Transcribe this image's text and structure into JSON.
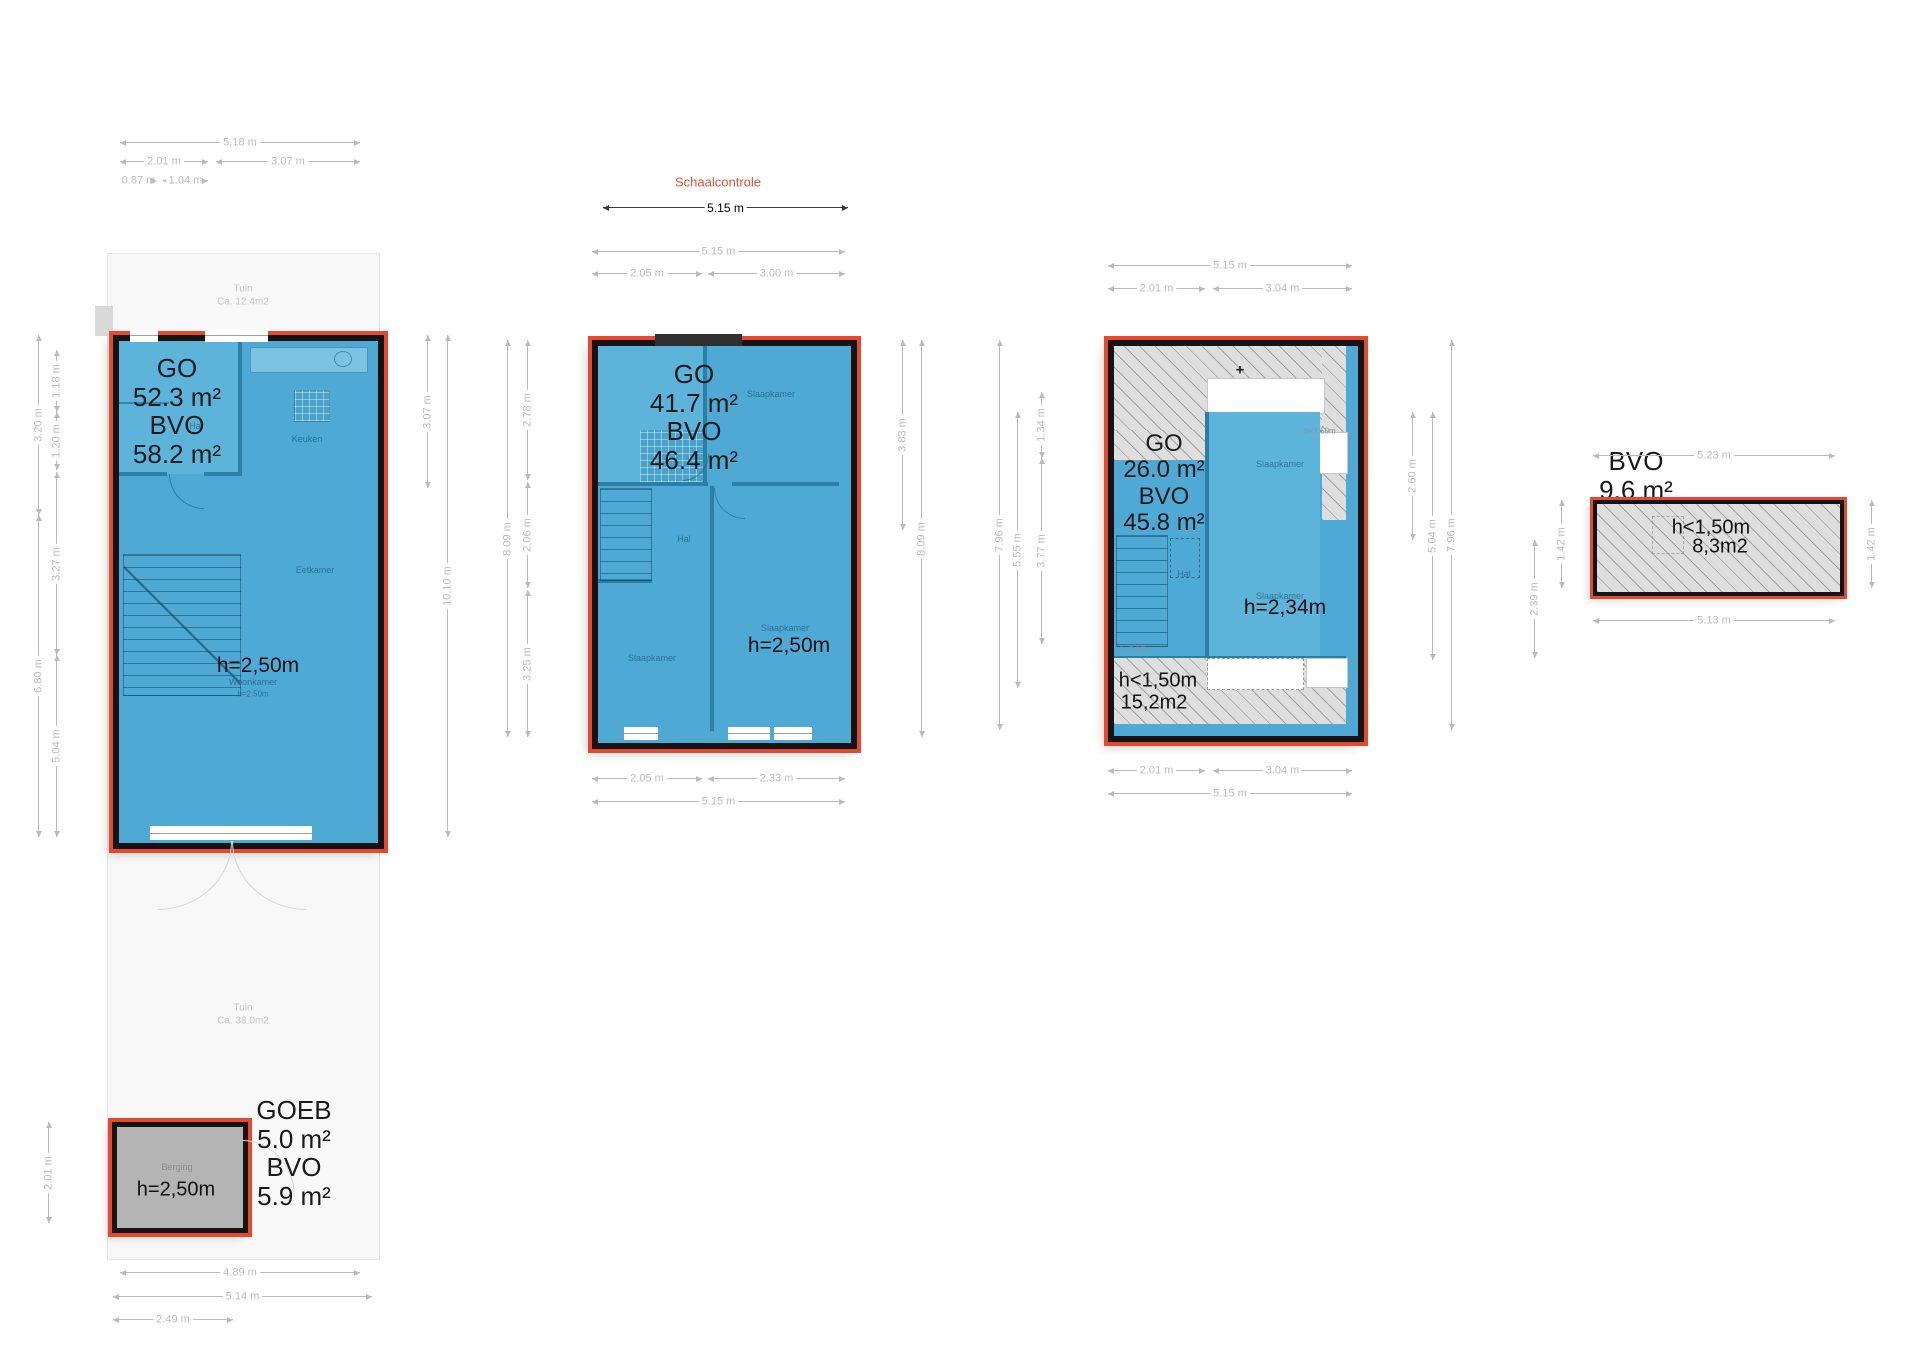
{
  "document": {
    "type": "floor-plan-measurement-drawing"
  },
  "colors": {
    "plan_fill": "#4FA9D5",
    "plan_border": "#141414",
    "highlight_outline": "#E8492B",
    "dimension_text": "#BBBBBB",
    "hatch_background": "#DEDEDE",
    "storage_fill": "#B4B4B4",
    "garden_background": "#F8F8F8",
    "accent_text": "#D9533B"
  },
  "scale_check": {
    "label": "Schaalcontrole",
    "value": "5.15 m"
  },
  "garden": {
    "front_name": "Tuin",
    "front_area": "Ca. 12.4m2",
    "back_name": "Tuin",
    "back_area": "Ca. 38.0m2"
  },
  "plans": [
    {
      "name": "ground-floor",
      "go_label": "GO",
      "go_value": "52.3 m²",
      "bvo_label": "BVO",
      "bvo_value": "58.2 m²",
      "height": "h=2,50m",
      "rooms": {
        "hal": "Hal",
        "keuken": "Keuken",
        "eetkamer": "Eetkamer",
        "woonkamer": "Woonkamer",
        "woonkamer_h": "h=2,50m"
      }
    },
    {
      "name": "first-floor",
      "go_label": "GO",
      "go_value": "41.7 m²",
      "bvo_label": "BVO",
      "bvo_value": "46.4 m²",
      "height": "h=2,50m",
      "rooms": {
        "hal": "Hal",
        "slaapkamer_top": "Slaapkamer",
        "slaapkamer_left": "Slaapkamer",
        "slaapkamer_right": "Slaapkamer"
      }
    },
    {
      "name": "second-floor",
      "go_label": "GO",
      "go_value": "26.0 m²",
      "bvo_label": "BVO",
      "bvo_value": "45.8 m²",
      "height": "h=2,34m",
      "low_area_label": "h<1,50m",
      "low_area_value": "15,2m2",
      "low_small_left": "h<1,50m",
      "low_small_right": "h<1,50m",
      "plus": "+",
      "rooms": {
        "hal": "Hal",
        "slaapkamer": "Slaapkamer",
        "slaapkamer2": "Slaapkamer"
      }
    },
    {
      "name": "attic-low",
      "bvo_label": "BVO",
      "bvo_value": "9.6 m²",
      "low_area_label": "h<1,50m",
      "low_area_value": "8,3m2"
    }
  ],
  "storage": {
    "goeb_label": "GOEB",
    "goeb_value": "5.0 m²",
    "bvo_label": "BVO",
    "bvo_value": "5.9 m²",
    "height": "h=2,50m",
    "room": "Berging"
  },
  "dimensions": {
    "plan1_top": [
      "5.18 m",
      "2.01 m",
      "3.07 m",
      "0.87 m",
      "1.04 m"
    ],
    "plan1_left": [
      "1.18 m",
      "1.20 m",
      "3.27 m",
      "5.04 m",
      "3.20 m",
      "6.80 m"
    ],
    "plan1_right": [
      "3.07 m",
      "10.10 m"
    ],
    "plan1_bottom": [
      "4.89 m",
      "5.14 m",
      "2.49 m"
    ],
    "storage_left": [
      "2.01 m"
    ],
    "plan2_top": [
      "5.15 m",
      "2.05 m",
      "3.00 m"
    ],
    "plan2_left": [
      "2.78 m",
      "2.06 m",
      "3.25 m",
      "8.09 m"
    ],
    "plan2_right": [
      "3.83 m",
      "8.09 m"
    ],
    "plan2_bottom": [
      "2.05 m",
      "2.33 m",
      "5.15 m"
    ],
    "plan3_top": [
      "5.15 m",
      "2.01 m",
      "3.04 m"
    ],
    "plan3_left": [
      "1.34 m",
      "3.77 m",
      "5.55 m",
      "7.96 m"
    ],
    "plan3_right": [
      "2.60 m",
      "5.04 m",
      "7.96 m",
      "2.39 m"
    ],
    "plan3_bottom": [
      "2.01 m",
      "3.04 m",
      "5.15 m"
    ],
    "plan4_top": [
      "5.23 m"
    ],
    "plan4_bottom": [
      "5.13 m"
    ],
    "plan4_sides": [
      "1.42 m",
      "1.42 m"
    ]
  }
}
